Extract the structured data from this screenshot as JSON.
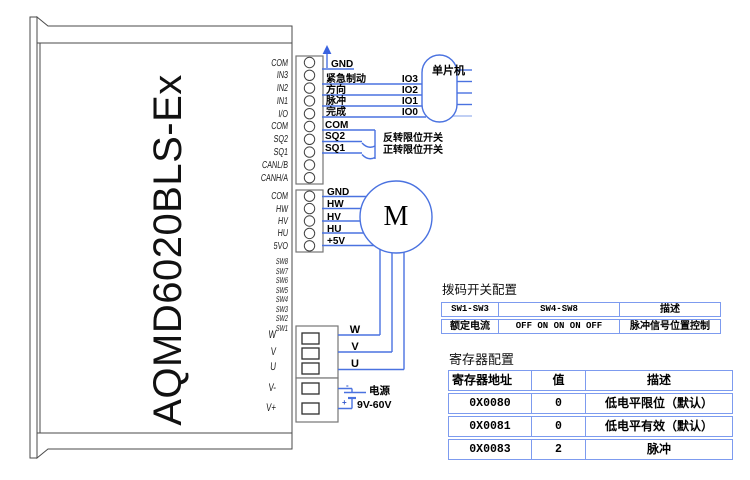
{
  "device": {
    "model": "AQMD6020BLS-Ex"
  },
  "io_connector": {
    "pins": [
      "COM",
      "IN3",
      "IN2",
      "IN1",
      "I/O",
      "COM",
      "SQ2",
      "SQ1",
      "CANL/B",
      "CANH/A"
    ]
  },
  "hall_connector": {
    "pins": [
      "COM",
      "HW",
      "HV",
      "HU",
      "5VO"
    ]
  },
  "dip_switch_pins": [
    "SW8",
    "SW7",
    "SW6",
    "SW5",
    "SW4",
    "SW3",
    "SW2",
    "SW1"
  ],
  "power_connector": {
    "pins": [
      "W",
      "V",
      "U",
      "V-",
      "V+"
    ]
  },
  "control_wiring": {
    "ground_label": "GND",
    "com_label": "COM",
    "mcu_label": "单片机",
    "signals": [
      {
        "name": "紧急制动",
        "io": "IO3"
      },
      {
        "name": "方向",
        "io": "IO2"
      },
      {
        "name": "脉冲",
        "io": "IO1"
      },
      {
        "name": "完成",
        "io": "IO0"
      }
    ],
    "limit_switches": [
      {
        "pin": "SQ2",
        "desc": "反转限位开关"
      },
      {
        "pin": "SQ1",
        "desc": "正转限位开关"
      }
    ]
  },
  "hall_wiring": {
    "labels": [
      "GND",
      "HW",
      "HV",
      "HU",
      "+5V"
    ]
  },
  "motor": {
    "label": "M",
    "phase_labels": [
      "W",
      "V",
      "U"
    ]
  },
  "power_supply": {
    "name": "电源",
    "voltage": "9V-60V",
    "minus": "-",
    "plus": "+"
  },
  "dip_table": {
    "title": "拨码开关配置",
    "headers": [
      "SW1-SW3",
      "SW4-SW8",
      "描述"
    ],
    "rows": [
      [
        "额定电流",
        "OFF ON ON ON OFF",
        "脉冲信号位置控制"
      ]
    ]
  },
  "register_table": {
    "title": "寄存器配置",
    "headers": [
      "寄存器地址",
      "值",
      "描述"
    ],
    "rows": [
      [
        "0X0080",
        "0",
        "低电平限位（默认）"
      ],
      [
        "0X0081",
        "0",
        "低电平有效（默认）"
      ],
      [
        "0X0083",
        "2",
        "脉冲"
      ]
    ]
  },
  "colors": {
    "wire_blue": "#4a72e0",
    "table_border": "#7d9bef",
    "outline_grey": "#4a4a4a",
    "connector_grey": "#767676"
  }
}
